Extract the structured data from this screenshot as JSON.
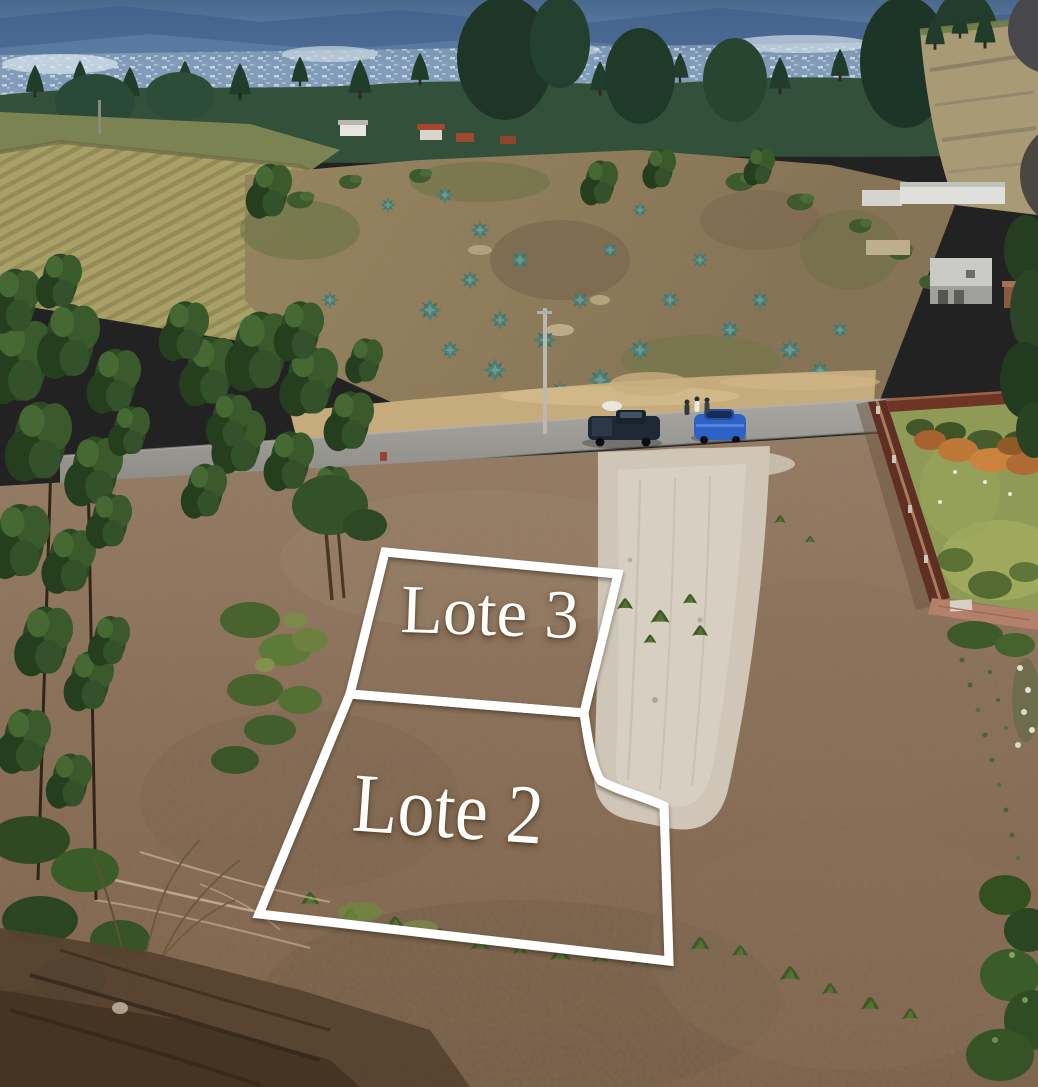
{
  "photo": {
    "kind": "aerial-drone-photo",
    "scene": "Hillside land lots marked for sale beside a rural road; Andean valley with distant city, eucalyptus trees, agave slope and walled garden",
    "elements": [
      "distant-mountains",
      "distant-city",
      "distant-tree-line",
      "plowed-field",
      "pasture",
      "agave-hillside",
      "small-houses",
      "rural-road",
      "sandy-embankment",
      "utility-pole",
      "pickup-truck",
      "blue-hatchback",
      "people",
      "dirt-lot",
      "gravel-access-strip",
      "eucalyptus-trees",
      "scrub-bushes",
      "brick-wall",
      "walled-garden",
      "orange-shrubs",
      "weed-tufts",
      "tree-shadow-corner"
    ]
  },
  "overlay": {
    "line_color": "#ffffff",
    "label_color": "#fdfdfa",
    "lots": [
      {
        "id": "lote-3",
        "label": "Lote 3"
      },
      {
        "id": "lote-2",
        "label": "Lote 2"
      }
    ]
  },
  "ui_artifacts": {
    "circle_top_color": "#48484c",
    "circle_bottom_color": "#4a4640"
  },
  "colors": {
    "sky_top": "#49688e",
    "sky_bottom": "#93abc4",
    "distant_city": "#d7e2ea",
    "tree_dark": "#25402e",
    "pasture": "#7b8352",
    "field_base": "#a9a068",
    "field_furrow": "#948b57",
    "hillside": "#8f7f60",
    "agave": "#4f7f74",
    "embankment": "#c6ab7d",
    "road": "#9c9a95",
    "truck": "#1e2936",
    "car": "#2e62c6",
    "dirt": "#8c7159",
    "gravel": "#cfc6b7",
    "brick_wall_dark": "#5f2f23",
    "brick_wall_pink": "#b5806b",
    "garden_grass": "#8e9a55",
    "shrub_orange": "#bd7838",
    "foliage": "#2f4a22",
    "shadow_corner": "#55422f"
  }
}
